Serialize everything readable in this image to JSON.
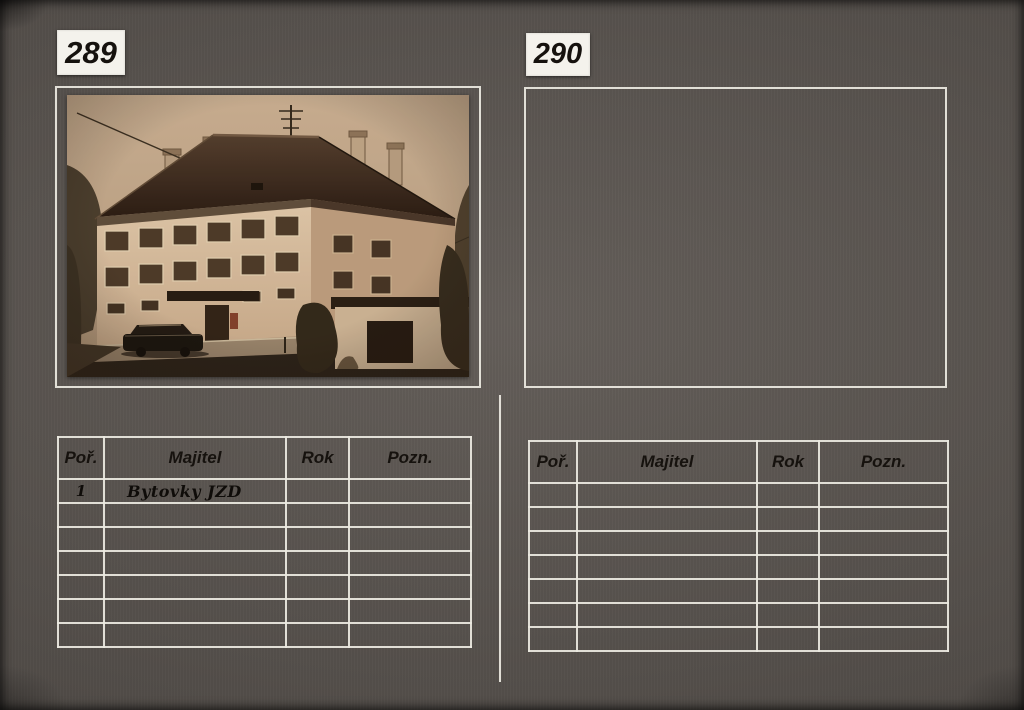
{
  "page": {
    "entries": [
      {
        "number": "289",
        "has_photo": true,
        "photo_description": "sepia photograph of a three-storey apartment house (bytovka) with hipped roof, chimneys, tv-antenna, dark car parked in front, bushes and small outbuilding at right",
        "table": {
          "headers": [
            "Poř.",
            "Majitel",
            "Rok",
            "Pozn."
          ],
          "rows": [
            [
              "1",
              "Bytovky JZD",
              "",
              ""
            ],
            [
              "",
              "",
              "",
              ""
            ],
            [
              "",
              "",
              "",
              ""
            ],
            [
              "",
              "",
              "",
              ""
            ],
            [
              "",
              "",
              "",
              ""
            ],
            [
              "",
              "",
              "",
              ""
            ],
            [
              "",
              "",
              "",
              ""
            ]
          ]
        }
      },
      {
        "number": "290",
        "has_photo": false,
        "photo_description": "empty photo frame",
        "table": {
          "headers": [
            "Poř.",
            "Majitel",
            "Rok",
            "Pozn."
          ],
          "rows": [
            [
              "",
              "",
              "",
              ""
            ],
            [
              "",
              "",
              "",
              ""
            ],
            [
              "",
              "",
              "",
              ""
            ],
            [
              "",
              "",
              "",
              ""
            ],
            [
              "",
              "",
              "",
              ""
            ],
            [
              "",
              "",
              "",
              ""
            ],
            [
              "",
              "",
              "",
              ""
            ]
          ]
        }
      }
    ]
  },
  "colors": {
    "paper": "#5c5651",
    "drawn_lines": "#ece9e1",
    "ink": "#16120e",
    "card": "#f4f2ec",
    "photo_sky": "#c3aa8e",
    "photo_roof": "#302116",
    "photo_facade": "#d6bfa2"
  }
}
